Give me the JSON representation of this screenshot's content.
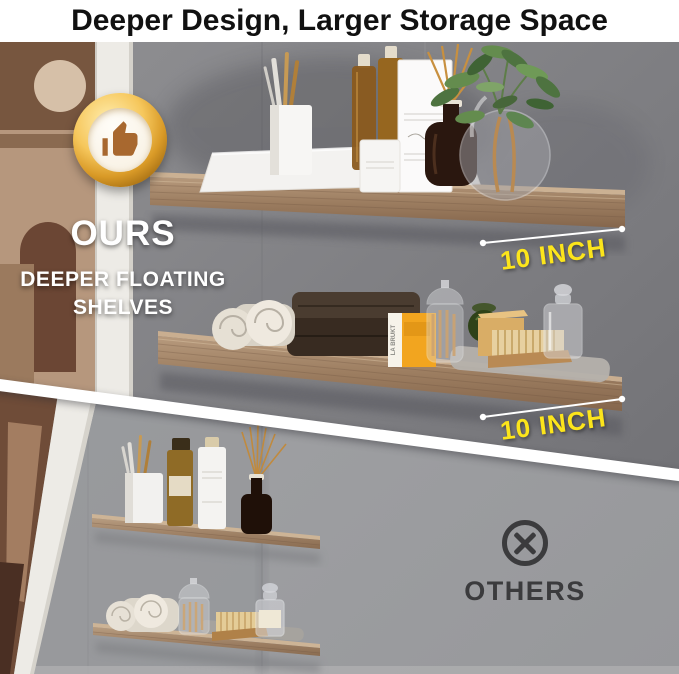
{
  "title": "Deeper Design, Larger Storage Space",
  "ours_section": {
    "badge_icon": "thumbs-up-gold-medal",
    "heading": "OURS",
    "subheading_line1": "DEEPER FLOATING",
    "subheading_line2": "SHELVES",
    "depth_label_top_shelf": "10 INCH",
    "depth_label_bottom_shelf": "10 INCH",
    "soap_box_label": "LA BRUKT"
  },
  "others_section": {
    "icon": "x-circle",
    "heading": "OTHERS"
  },
  "colors": {
    "accent_yellow": "#FCE51B",
    "title_text": "#111111",
    "ours_wall_gray": "#7E7E82",
    "others_wall_gray": "#9C9DA0",
    "wood": "#A1846A",
    "badge_gold": "#E8B54A",
    "others_text": "#3B3B3D",
    "divider_white": "#FFFFFF"
  }
}
